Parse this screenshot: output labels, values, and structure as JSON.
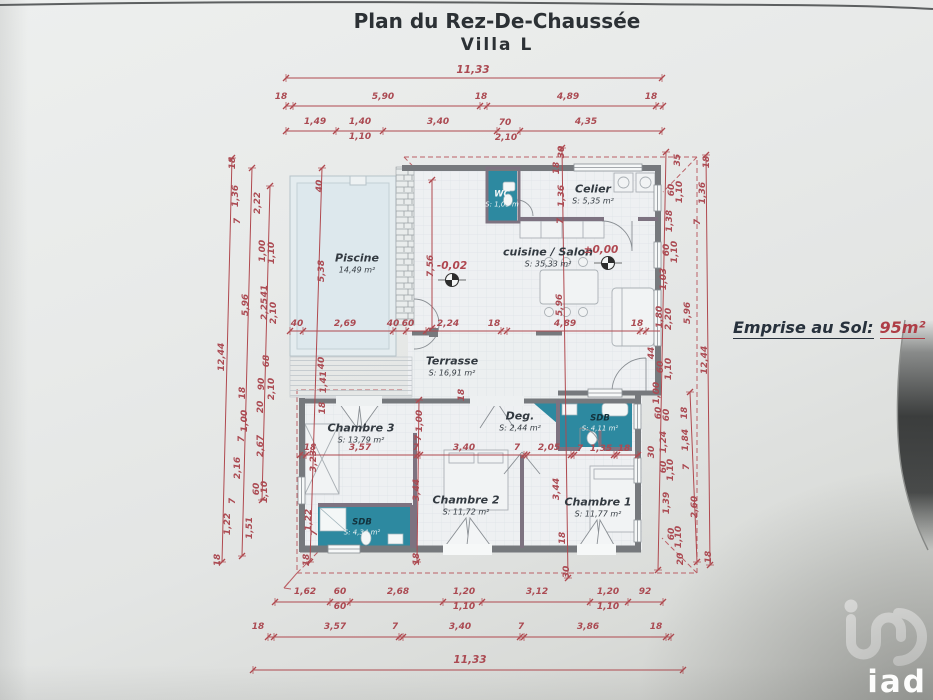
{
  "title": {
    "line1": "Plan du Rez-De-Chaussée",
    "line2": "Villa L"
  },
  "annotation": {
    "emprise_label": "Emprise au Sol:",
    "emprise_value": "95m²"
  },
  "levels": {
    "salon": "±0,00",
    "terrasse": "-0,02"
  },
  "logo": {
    "brand": "iad"
  },
  "rooms": [
    {
      "name": "Piscine",
      "area": "14,49 m²"
    },
    {
      "name": "WC",
      "area": "S: 1,09 m"
    },
    {
      "name": "Celier",
      "area": "S: 5,35 m²"
    },
    {
      "name": "cuisine / Salon",
      "area": "S: 35,33 m²"
    },
    {
      "name": "Terrasse",
      "area": "S: 16,91 m²"
    },
    {
      "name": "Chambre 3",
      "area": "S: 13,79 m²"
    },
    {
      "name": "Deg.",
      "area": "S: 2,44 m²"
    },
    {
      "name": "SDB",
      "area": "S: 4,11 m²"
    },
    {
      "name": "Chambre 2",
      "area": "S: 11,72 m²"
    },
    {
      "name": "Chambre 1",
      "area": "S: 11,77 m²"
    },
    {
      "name": "SDB",
      "area": "S: 4,34 m²"
    }
  ],
  "dimensions": {
    "top1": [
      "11,33"
    ],
    "top2": [
      "18",
      "5,90",
      "18",
      "4,89",
      "18"
    ],
    "top3": [
      "1,49",
      "1,40",
      "3,40",
      "70",
      "4,35"
    ],
    "top3_sub": [
      "1,10",
      "2,10"
    ],
    "mid": [
      "40",
      "2,69",
      "40",
      "60",
      "2,24",
      "18",
      "4,89",
      "18"
    ],
    "inner_row": [
      "18",
      "3,57",
      "7",
      "3,40",
      "7",
      "2,05",
      "7",
      "1,35",
      "18"
    ],
    "bottom1": [
      "1,62",
      "60",
      "2,68",
      "1,20",
      "3,12",
      "1,20",
      "92"
    ],
    "bottom1_sub": [
      "60",
      "1,10",
      "1,10"
    ],
    "bottom2": [
      "18",
      "3,57",
      "7",
      "3,40",
      "7",
      "3,86",
      "18"
    ],
    "bottom3": [
      "11,33"
    ],
    "left": [
      "18",
      "1,36",
      "2,22",
      "7",
      "1,00",
      "1,10",
      "41",
      "5,96",
      "2,25",
      "2,10",
      "12,44",
      "68",
      "90",
      "2,10",
      "18",
      "20",
      "1,00",
      "7",
      "2,67",
      "2,16",
      "60",
      "1,10",
      "7",
      "1,22",
      "1,51",
      "18"
    ],
    "right": [
      "35",
      "18",
      "60",
      "1,10",
      "1,36",
      "1,38",
      "7",
      "60",
      "1,10",
      "1,03",
      "1,80",
      "2,20",
      "5,96",
      "44",
      "60",
      "1,10",
      "12,44",
      "1,00",
      "60",
      "60",
      "18",
      "1,24",
      "1,84",
      "30",
      "60",
      "1,10",
      "7",
      "1,39",
      "2,60",
      "60",
      "1,10",
      "20",
      "18"
    ],
    "left_wall": [
      "40",
      "5,38",
      "40",
      "1,41",
      "18",
      "3,23",
      "1,22",
      "7",
      "18"
    ],
    "center_col": [
      "30",
      "18",
      "1,36",
      "7",
      "5,96",
      "18",
      "30"
    ],
    "interior": [
      "7,56",
      "18",
      "1,00",
      "7",
      "3,44",
      "3,44",
      "18"
    ]
  },
  "colors": {
    "dimension_red": "#ab4a52",
    "wall_gray": "#76797d",
    "wet_room_teal": "#2d89a0",
    "pool_blue": "#dde8ed"
  }
}
